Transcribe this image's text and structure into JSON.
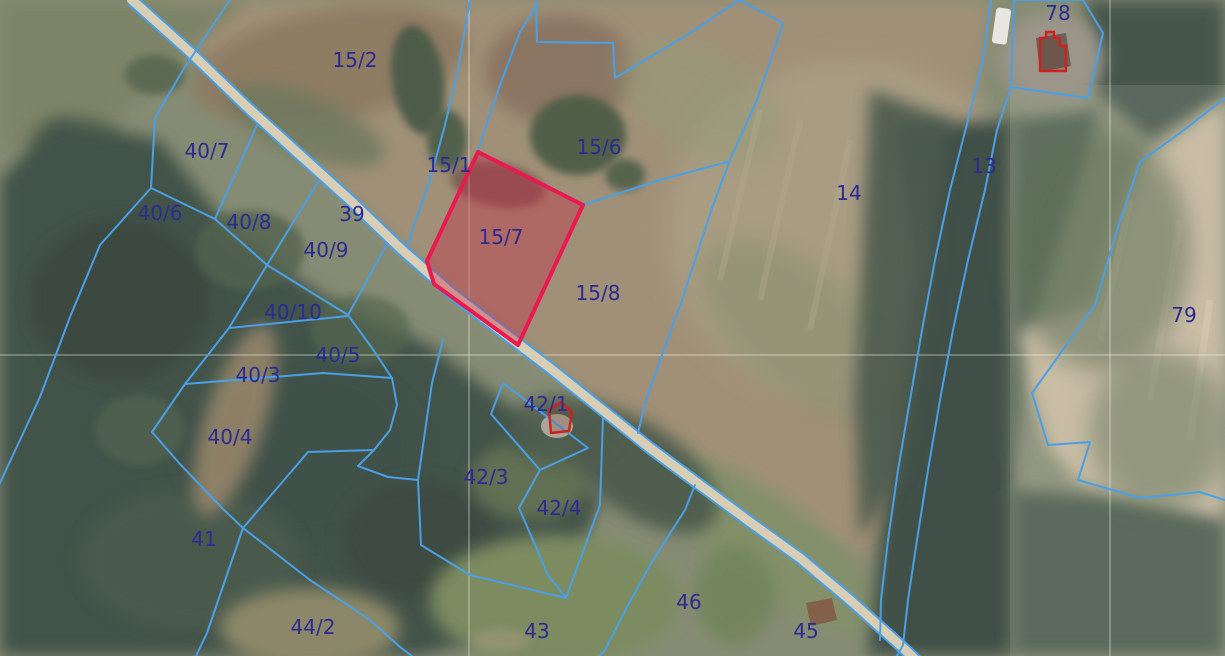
{
  "app": {
    "type": "cadastral-map-view",
    "description": "Aerial orthophoto with cadastral parcel boundary overlay, one parcel highlighted"
  },
  "colors": {
    "boundary_blue": "#4aa0e6",
    "label_navy": "#2b2b92",
    "highlight_stroke": "#ea1950",
    "highlight_fill": "rgba(201,41,72,0.38)",
    "building_red": "#cf1f1f",
    "road_fill": "#d8ceb5",
    "grid_white": "rgba(250,250,244,0.55)"
  },
  "grid": {
    "vertical_x": [
      469,
      1110
    ],
    "horizontal_y": [
      355
    ]
  },
  "road": {
    "center": "132,0 190,52 245,105 300,155 350,200 400,248 450,292 500,330 550,368 600,408 650,448 700,485 750,522 800,558 850,600 900,645 918,662",
    "edge_offset": 5.5
  },
  "highlight": {
    "parcel_id": "15/7",
    "points": "478,152 583,205 518,345 434,284 427,261"
  },
  "parcel_labels": [
    {
      "id": "15/2",
      "x": 355,
      "y": 60
    },
    {
      "id": "40/7",
      "x": 207,
      "y": 151
    },
    {
      "id": "40/6",
      "x": 160,
      "y": 213
    },
    {
      "id": "40/8",
      "x": 249,
      "y": 222
    },
    {
      "id": "39",
      "x": 352,
      "y": 214
    },
    {
      "id": "40/9",
      "x": 326,
      "y": 250
    },
    {
      "id": "15/1",
      "x": 449,
      "y": 165
    },
    {
      "id": "15/6",
      "x": 599,
      "y": 147
    },
    {
      "id": "15/7",
      "x": 501,
      "y": 237
    },
    {
      "id": "15/8",
      "x": 598,
      "y": 293
    },
    {
      "id": "14",
      "x": 849,
      "y": 193
    },
    {
      "id": "13",
      "x": 984,
      "y": 166
    },
    {
      "id": "78",
      "x": 1058,
      "y": 13
    },
    {
      "id": "79",
      "x": 1184,
      "y": 315
    },
    {
      "id": "40/10",
      "x": 293,
      "y": 312
    },
    {
      "id": "40/5",
      "x": 338,
      "y": 355
    },
    {
      "id": "40/3",
      "x": 258,
      "y": 375
    },
    {
      "id": "40/4",
      "x": 230,
      "y": 437
    },
    {
      "id": "41",
      "x": 204,
      "y": 539
    },
    {
      "id": "44/2",
      "x": 313,
      "y": 627
    },
    {
      "id": "42/1",
      "x": 546,
      "y": 404
    },
    {
      "id": "42/3",
      "x": 486,
      "y": 477
    },
    {
      "id": "42/4",
      "x": 559,
      "y": 508
    },
    {
      "id": "43",
      "x": 537,
      "y": 631
    },
    {
      "id": "46",
      "x": 689,
      "y": 602
    },
    {
      "id": "45",
      "x": 806,
      "y": 631
    }
  ],
  "boundaries": [
    {
      "name": "line-15-2-west",
      "points": "230,0 203,40 183,70 155,118 151,188"
    },
    {
      "name": "line-40-6-southwest",
      "points": "151,188 100,245 70,317 40,397 0,483"
    },
    {
      "name": "line-40-6-north",
      "points": "151,188 215,219"
    },
    {
      "name": "line-40-7-east",
      "points": "215,219 257,125"
    },
    {
      "name": "line-40-rail",
      "points": "215,219 267,265 348,315"
    },
    {
      "name": "line-40-9-east",
      "points": "348,315 387,244"
    },
    {
      "name": "line-40-8-east",
      "points": "267,265 318,182"
    },
    {
      "name": "line-40-10-west",
      "points": "267,265 229,328"
    },
    {
      "name": "line-40-10-south",
      "points": "229,328 348,316"
    },
    {
      "name": "line-40-west-rail",
      "points": "229,328 185,384 152,432"
    },
    {
      "name": "line-40-3-south",
      "points": "185,384 323,373 392,378"
    },
    {
      "name": "line-40-5-east",
      "points": "348,315 372,348 392,378 397,405 390,430 374,450 358,466 388,477 418,480"
    },
    {
      "name": "line-40-4-south",
      "points": "152,432 180,464 222,508 243,528 308,452 374,450"
    },
    {
      "name": "line-44-2-north",
      "points": "243,528 310,580 370,620 400,647 412,656"
    },
    {
      "name": "line-41-south",
      "points": "243,528 207,633 196,656"
    },
    {
      "name": "line-42-3-west",
      "points": "443,340 432,383 418,480 421,545 470,575 566,598"
    },
    {
      "name": "line-42-3-east",
      "points": "540,470 519,508 548,575 566,598"
    },
    {
      "name": "line-42-4-east",
      "points": "566,598 600,505 603,418"
    },
    {
      "name": "line-43-east",
      "points": "695,485 685,510 653,560 627,607 605,650 600,656"
    },
    {
      "name": "line-15-6-staircase",
      "points": "536,0 537,42 613,43 615,78 687,35 739,0"
    },
    {
      "name": "line-14-west",
      "points": "739,0 783,23 757,100 730,160 712,208 695,260 682,300 662,355 646,400 638,433"
    },
    {
      "name": "line-15-6-south",
      "points": "583,205 660,180 727,162"
    },
    {
      "name": "line-15-1-east",
      "points": "537,5 520,32 500,85 483,135 478,152"
    },
    {
      "name": "line-15-1-west",
      "points": "470,0 458,70 445,125 430,180 414,225 408,246"
    },
    {
      "name": "line-13-west",
      "points": "991,0 983,60 968,120 950,190 935,260 922,330 910,400 898,470 888,540 881,600 880,640"
    },
    {
      "name": "line-13-east",
      "points": "1011,87 997,130 985,190 968,260 953,330 940,400 928,470 917,540 908,600 903,645 897,656"
    },
    {
      "name": "line-79-west",
      "points": "1225,98 1180,133 1140,162 1117,230 1095,305 1032,393 1048,445 1090,442 1078,480 1140,498 1200,492 1225,500"
    }
  ],
  "closed_boundaries": [
    {
      "name": "parcel-42-1-outline",
      "points": "503,383 588,448 540,470 491,414"
    },
    {
      "name": "parcel-78-outline",
      "points": "1014,0 1083,0 1103,33 1088,98 1011,87"
    }
  ],
  "buildings": [
    {
      "id": "78",
      "path": "M1040,46 L1040,38 L1046,38 L1046,32 L1054,32 L1054,38 L1060,38 L1060,46 L1066,46 L1066,71 L1040,71 Z"
    },
    {
      "id": "42/1",
      "path": "M549,410 L561,402 L572,412 L569,431 L551,433 Z"
    }
  ]
}
